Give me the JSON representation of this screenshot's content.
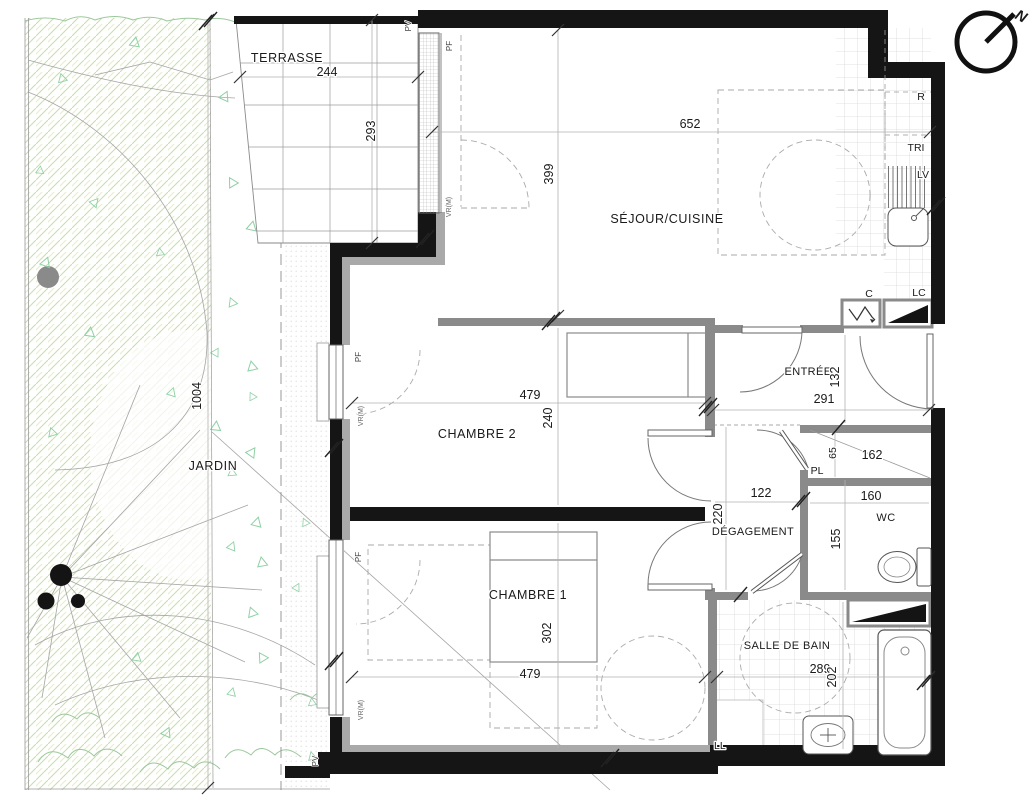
{
  "rooms": {
    "terrasse": "TERRASSE",
    "jardin": "JARDIN",
    "sejour": "SÉJOUR/CUISINE",
    "entree": "ENTRÉE",
    "chambre2": "CHAMBRE 2",
    "chambre1": "CHAMBRE 1",
    "degagement": "DÉGAGEMENT",
    "wc": "WC",
    "pl": "PL",
    "sdb": "SALLE DE BAIN"
  },
  "dims": {
    "terrasse_w": "244",
    "terrasse_h": "293",
    "jardin_h": "1004",
    "sejour_w": "652",
    "sejour_h": "399",
    "chambre2_w": "479",
    "chambre2_h": "240",
    "chambre1_w": "479",
    "chambre1_h": "302",
    "entree_w": "291",
    "entree_h": "132",
    "pl_h": "65",
    "pl_diag": "162",
    "degagement_w": "122",
    "degagement_h": "220",
    "wc_w": "160",
    "wc_h": "155",
    "sdb_w": "289",
    "sdb_h": "202"
  },
  "equipment": {
    "fridge": "R",
    "tri": "TRI",
    "dishwasher": "LV",
    "c_unit": "C",
    "lc_unit": "LC",
    "washer": "LL"
  },
  "windows": {
    "pv": "PV",
    "pf": "PF",
    "vr": "VR(M)"
  },
  "compass": {
    "north": "N"
  },
  "colors": {
    "wall": "#151515",
    "partition": "#8a8a8a",
    "insulation": "#a9a9a9",
    "garden_hatch": "#c5dfa8",
    "garden_accent": "#8fd0a5",
    "tile": "#d8d8d8"
  }
}
